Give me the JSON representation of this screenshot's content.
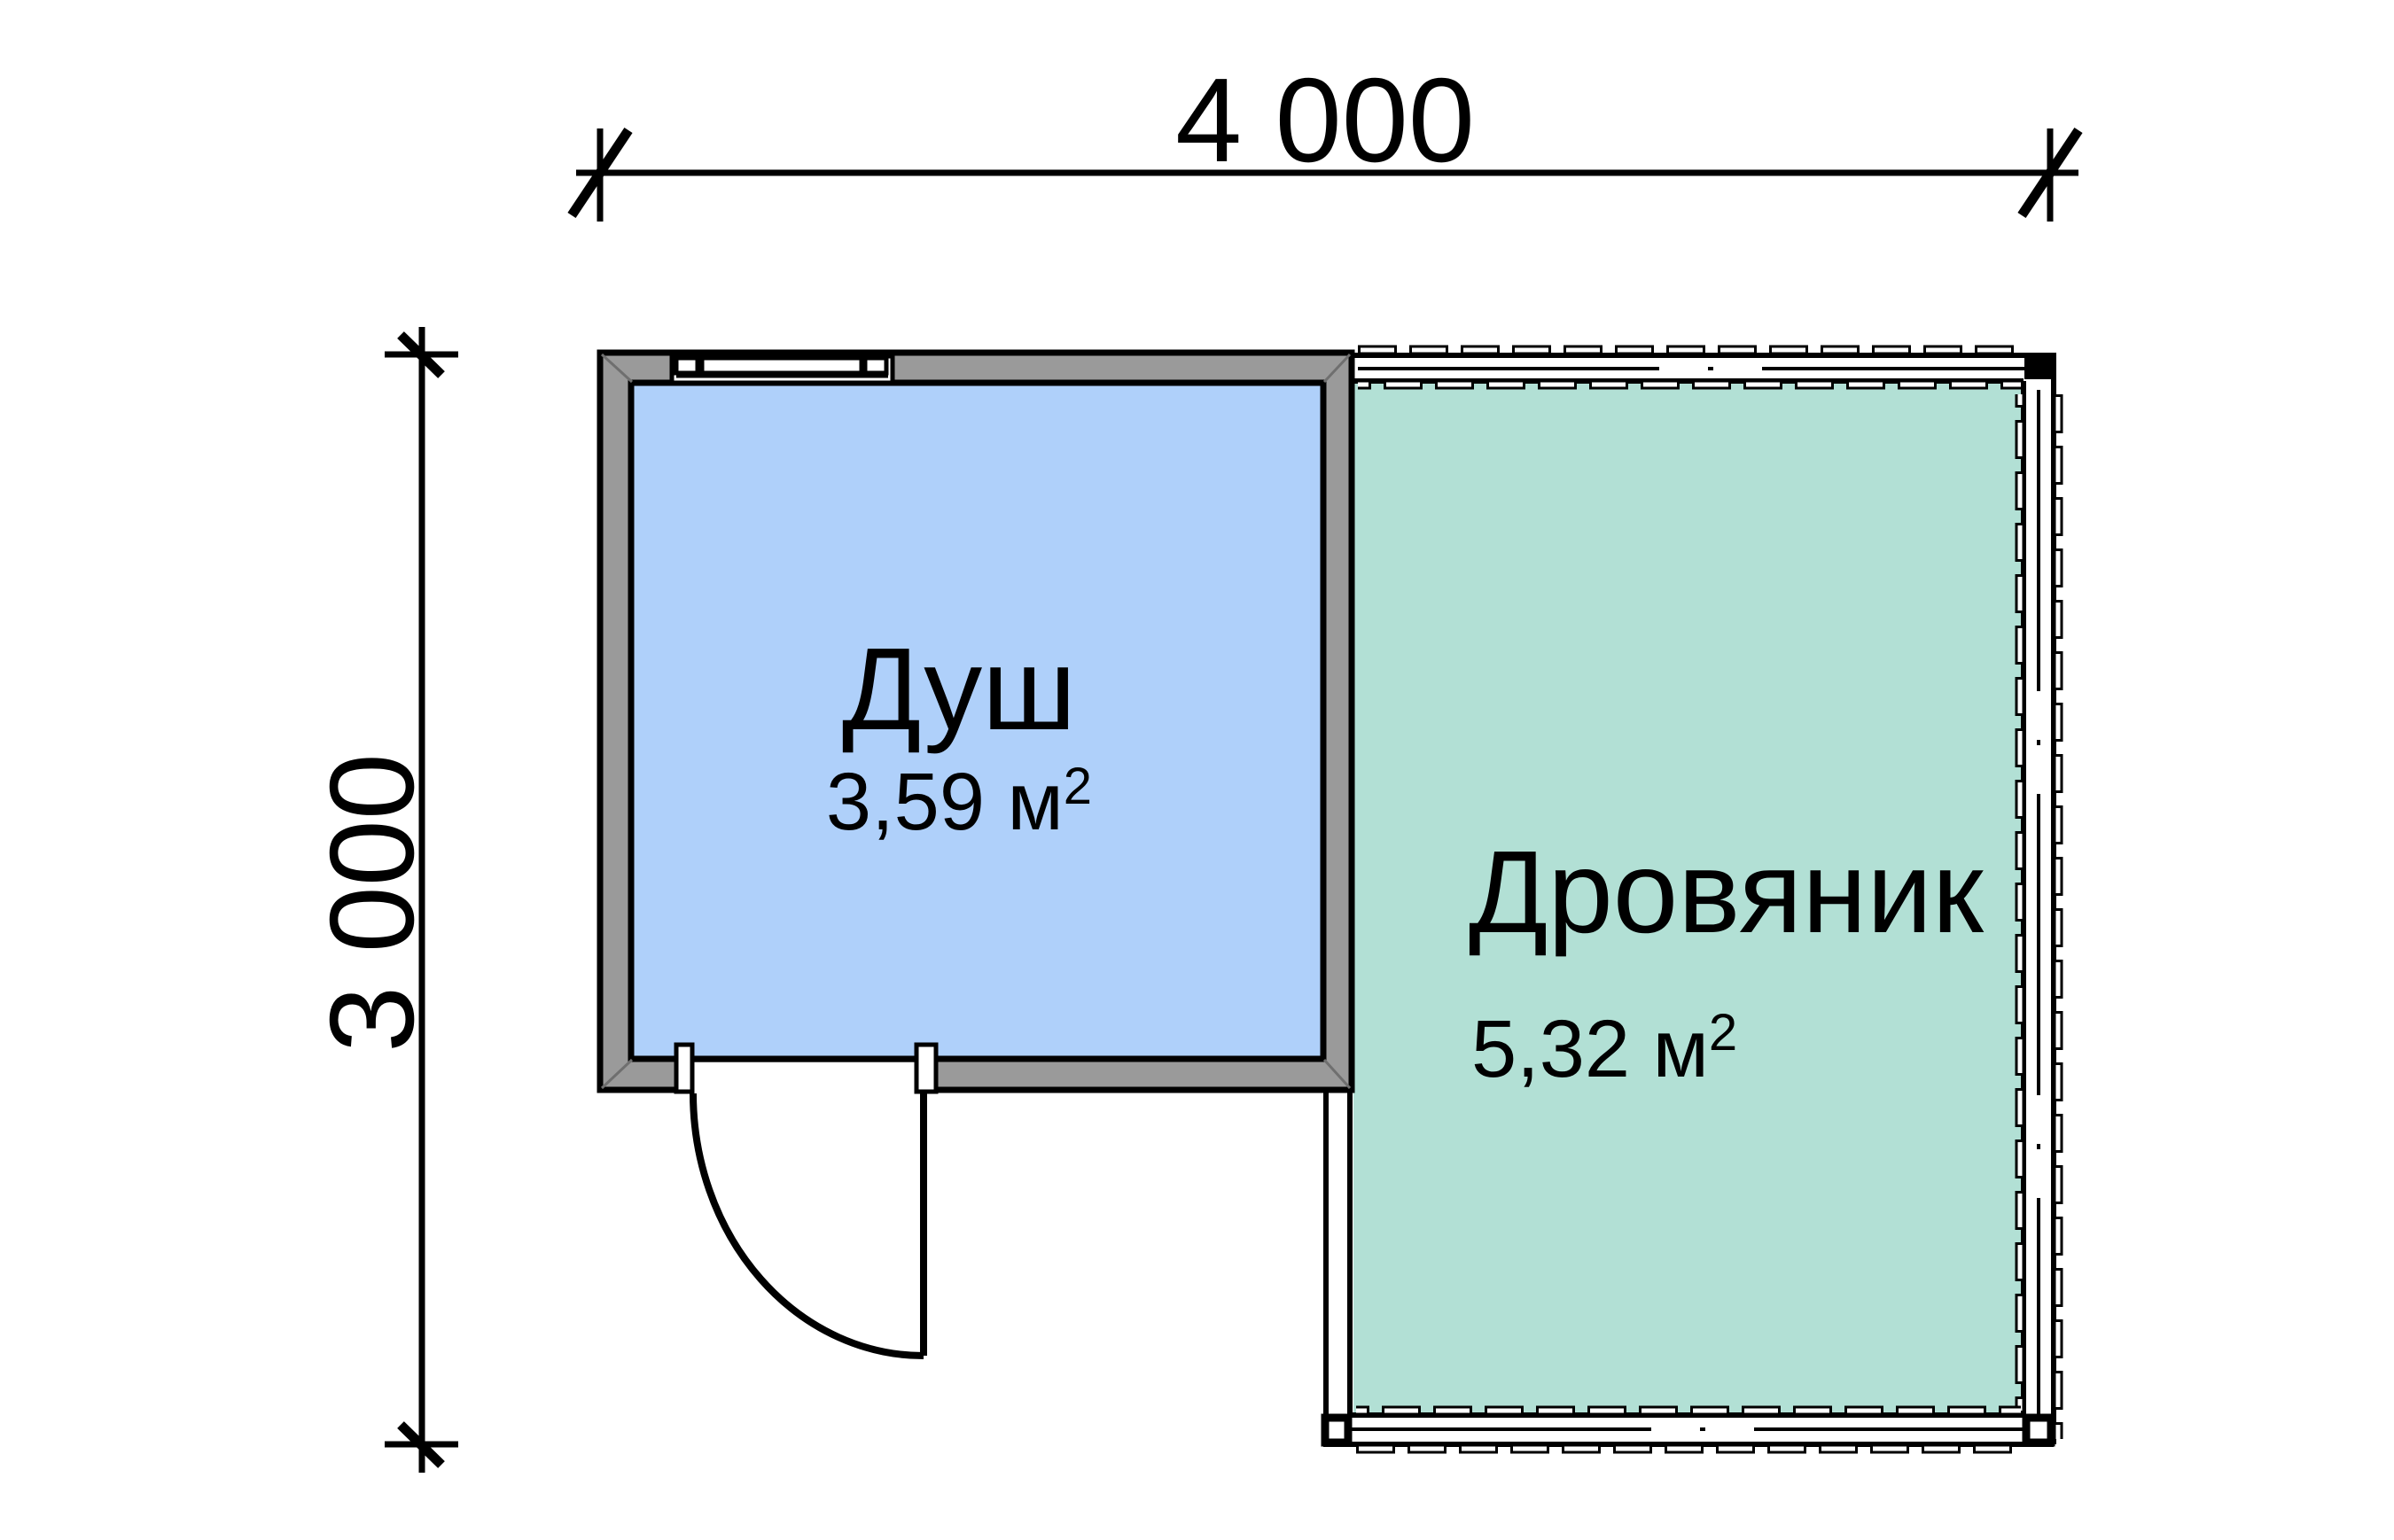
{
  "dimensions": {
    "width": "4 000",
    "height": "3 000"
  },
  "rooms": [
    {
      "name": "Душ",
      "area": "3,59 м",
      "area_sup": "2",
      "fill": "#AFD0FA"
    },
    {
      "name": "Дровяник",
      "area": "5,32 м",
      "area_sup": "2",
      "fill": "#B2E0D5"
    }
  ],
  "colors": {
    "wall_gray": "#9A9A9A",
    "line": "#000000",
    "background": "#FFFFFF"
  }
}
